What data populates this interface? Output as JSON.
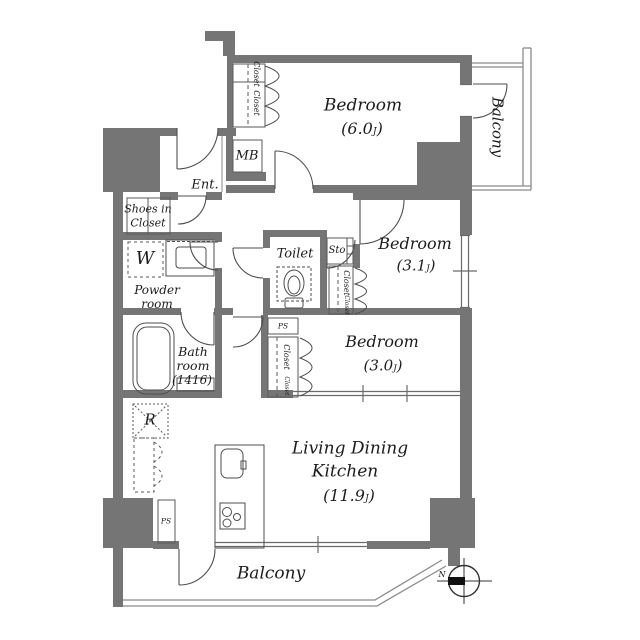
{
  "plan": {
    "rooms": {
      "bedroom6": {
        "name": "Bedroom",
        "area": "(6.0",
        "unit": "J",
        "close": ")"
      },
      "bedroom31": {
        "name": "Bedroom",
        "area": "(3.1",
        "unit": "J",
        "close": ")"
      },
      "bedroom30": {
        "name": "Bedroom",
        "area": "(3.0",
        "unit": "J",
        "close": ")"
      },
      "ldk": {
        "name_line1": "Living Dining",
        "name_line2": "Kitchen",
        "area": "(11.9",
        "unit": "J",
        "close": ")"
      }
    },
    "balcony_right": "Balcony",
    "balcony_bottom": "Balcony",
    "entrance": "Ent.",
    "shoes_closet": {
      "line1": "Shoes in",
      "line2": "Closet"
    },
    "powder_room": {
      "line1": "Powder",
      "line2": "room"
    },
    "bathroom": {
      "line1": "Bath",
      "line2": "room",
      "line3": "(1416)"
    },
    "toilet": "Toilet",
    "storage": "Sto",
    "meter_box": "MB",
    "washing_machine": "W",
    "refrigerator": "R",
    "pipe_space_kitchen": "PS",
    "pipe_space_bedroom": "PS",
    "closets": {
      "top1": "Closet",
      "top2": "Closet",
      "mid1": "Closet",
      "mid2": "Closet",
      "b30_1": "Closet",
      "b30_2": "Closet"
    },
    "compass_north": "N",
    "colors": {
      "wall": "#757575",
      "line": "#555555",
      "thin": "#8a8a8a"
    }
  }
}
